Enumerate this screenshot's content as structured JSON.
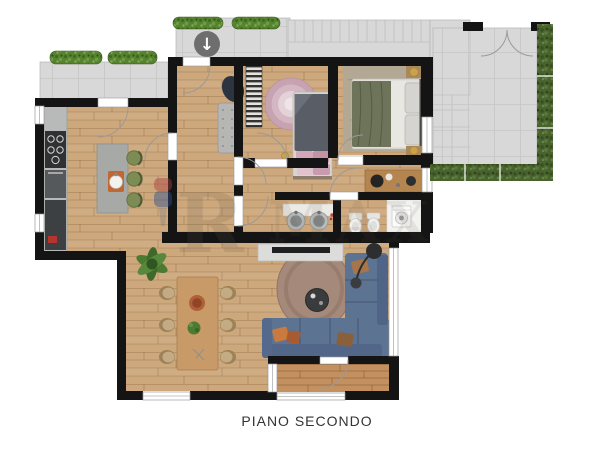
{
  "title": {
    "floor_label": "PIANO SECONDO"
  },
  "watermark": {
    "letter_r": "R",
    "letters_max": "MAX"
  },
  "icons": {
    "stairs_down_arrow": "↓"
  },
  "palette": {
    "wall": "#141414",
    "wood_floor": "#cda87c",
    "deck_floor": "#c2915f",
    "terrace_tile": "#d8d8d8",
    "hedge_green": "#49622e",
    "planter_green": "#568330",
    "sofa_blue": "#5d7392",
    "living_rug_brown": "#a5897a",
    "pink_rug": "#c7a3b2",
    "island_gray": "#a6a9a6",
    "stool_green": "#7d8c55",
    "duvet_green": "#6d7459",
    "dining_table_wood": "#c79a67",
    "accent_orange": "#c2672f",
    "watermark_red": "#a83c3c",
    "watermark_blue": "#2c4d8f"
  }
}
